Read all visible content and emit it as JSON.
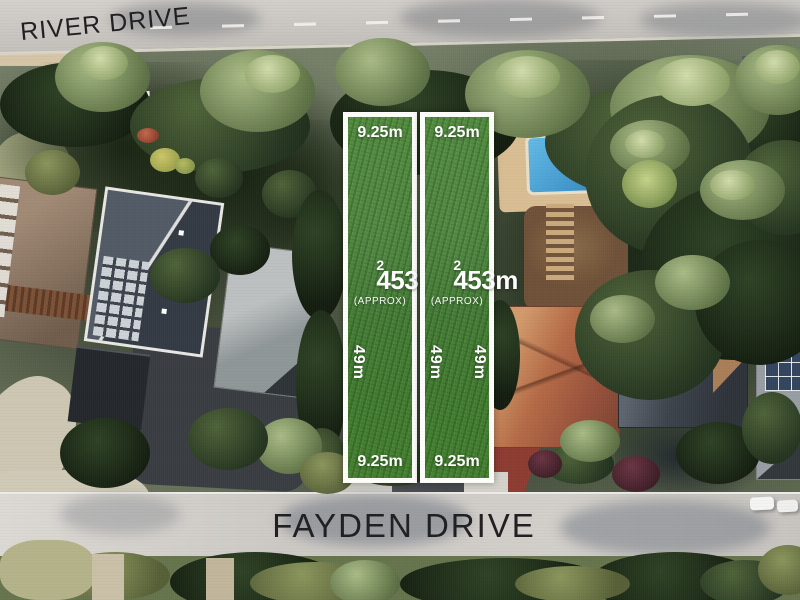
{
  "streets": {
    "river_drive": "RIVER DRIVE",
    "fayden_drive": "FAYDEN DRIVE"
  },
  "lots": [
    {
      "frontage_top": "9.25m",
      "area_value": "453m",
      "area_exponent": "2",
      "area_qualifier": "(APPROX)",
      "depth_left": "49m",
      "frontage_bottom": "9.25m"
    },
    {
      "frontage_top": "9.25m",
      "area_value": "453m",
      "area_exponent": "2",
      "area_qualifier": "(APPROX)",
      "depth_left": "49m",
      "depth_right": "49m",
      "frontage_bottom": "9.25m"
    }
  ],
  "colors": {
    "lot_green": "#458230",
    "lot_border": "#fdfdfa",
    "label_text": "#ffffff",
    "street_text": "#1f1f22",
    "road_gray": "#ccc9c4",
    "pool_blue": "#3f9fd4",
    "terracotta_roof": "#b56a45",
    "charcoal_roof": "#3d434b"
  }
}
